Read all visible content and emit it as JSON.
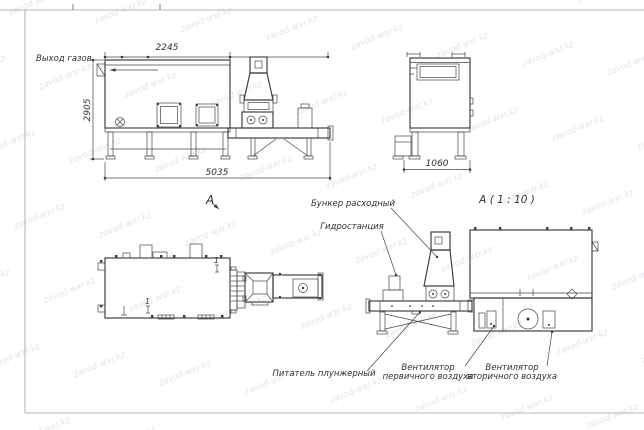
{
  "watermark": {
    "text": "zavod-wxr.kz",
    "color": "#c7cdd8"
  },
  "sheet": {
    "background": "#ffffff",
    "line_color": "#3c3e42",
    "frame_color": "#9aa0a6"
  },
  "views": {
    "front": {
      "gas_outlet_label": "Выход газов",
      "dim_width_top": "2245",
      "dim_height": "2905",
      "dim_length": "5035"
    },
    "side": {
      "dim_width": "1060"
    },
    "view_a": {
      "label": "А"
    },
    "detail_a": {
      "label": "А ( 1 : 10 )",
      "callouts": {
        "hopper": "Бункер расходный",
        "hydraulic_station": "Гидростанция",
        "feeder": "Питатель плунжерный",
        "primary_fan": [
          "Вентилятор",
          "первичного воздуха"
        ],
        "secondary_fan": [
          "Вентилятор",
          "вторичного воздуха"
        ]
      }
    },
    "plan": {
      "section_mark": "1"
    }
  }
}
